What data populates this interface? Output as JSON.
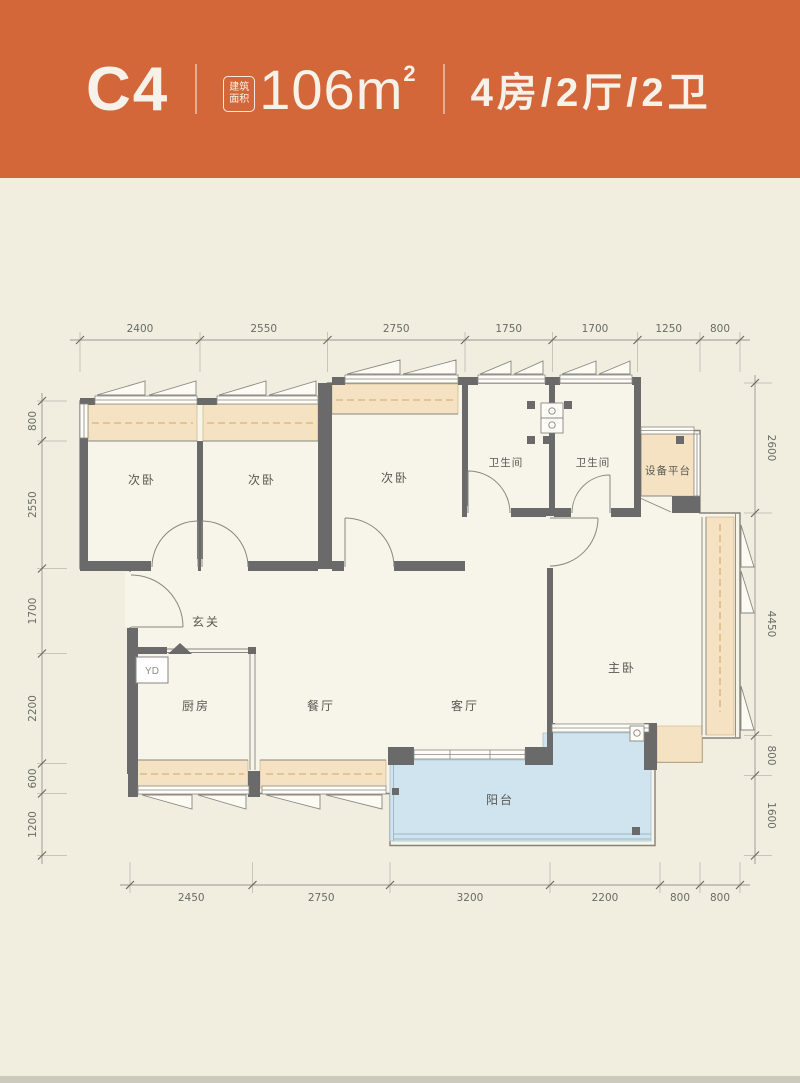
{
  "header": {
    "unit": "C4",
    "area_badge_line1": "建筑",
    "area_badge_line2": "面积",
    "area_value": "106m",
    "area_sup": "2",
    "spec": "4房/2厅/2卫"
  },
  "rooms": {
    "bedroom_a": "次卧",
    "bedroom_b": "次卧",
    "bedroom_c": "次卧",
    "bath_a": "卫生间",
    "bath_b": "卫生间",
    "equipment": "设备平台",
    "foyer": "玄关",
    "yd": "YD",
    "kitchen": "厨房",
    "dining": "餐厅",
    "living": "客厅",
    "master": "主卧",
    "balcony": "阳台"
  },
  "dims": {
    "top": [
      "2400",
      "2550",
      "2750",
      "1750",
      "1700",
      "1250",
      "800"
    ],
    "bottom": [
      "2450",
      "2750",
      "3200",
      "2200",
      "800",
      "800"
    ],
    "left": [
      "800",
      "2550",
      "1700",
      "2200",
      "600",
      "1200"
    ],
    "right": [
      "2600",
      "4450",
      "800",
      "1600"
    ]
  },
  "colors": {
    "header_bg": "#d4673a",
    "canvas": "#f1eee0",
    "plan_fill": "#f7f4e9",
    "wall": "#6a6a6a",
    "bay_window": "#f4e2c2",
    "balcony": "#cfe4ee",
    "dim_text": "#6b6b66"
  }
}
